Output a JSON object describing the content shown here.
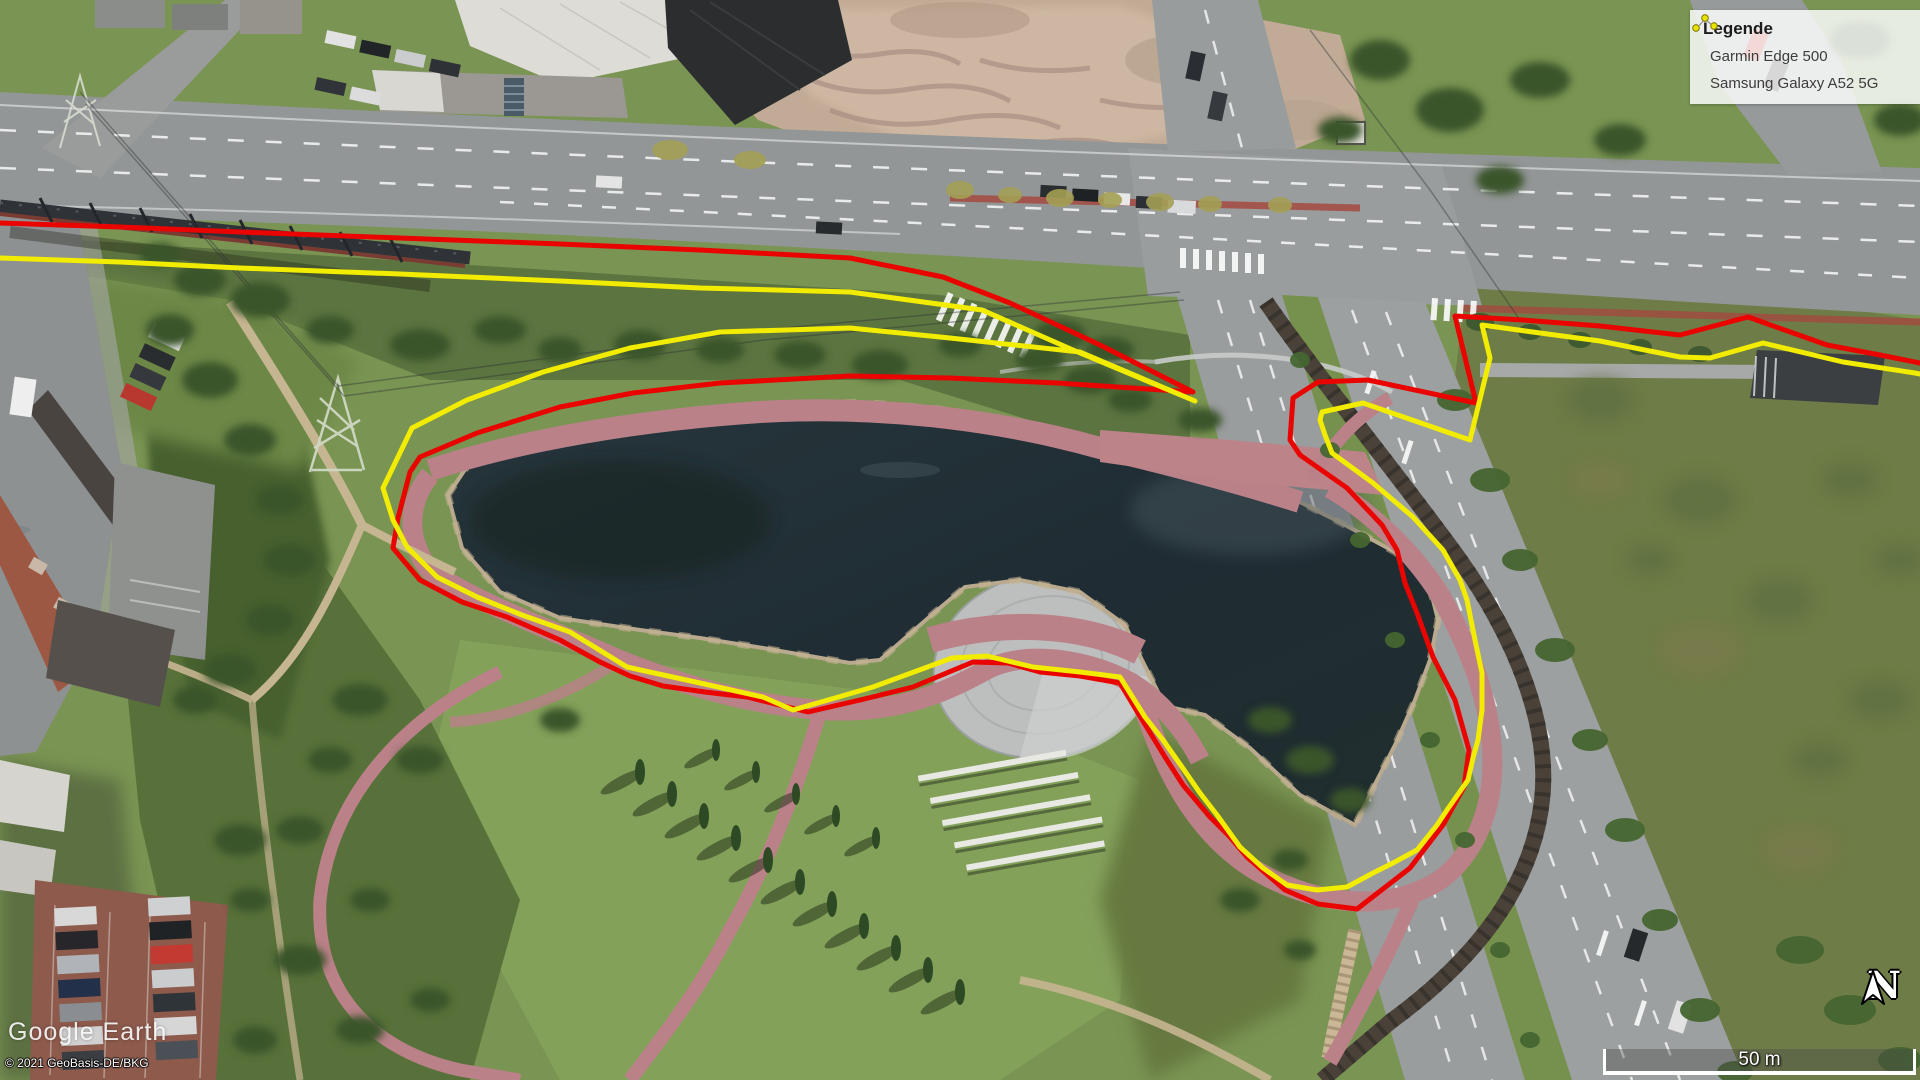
{
  "legend": {
    "title": "Legende",
    "items": [
      {
        "label": "Garmin Edge 500",
        "color": "#cc1f1f",
        "outline": "#7a0f0f"
      },
      {
        "label": "Samsung Galaxy A52 5G",
        "color": "#e8e400",
        "outline": "#8a8600"
      }
    ]
  },
  "watermark": {
    "brand": "Google Earth"
  },
  "attribution": {
    "copyright": "© 2021 GeoBasis-DE/BKG"
  },
  "scale_bar": {
    "label": "50 m"
  },
  "compass": {
    "label": "N"
  },
  "tracks": [
    {
      "name": "Garmin Edge 500",
      "color": "#ea0400",
      "width": 5,
      "points": [
        [
          0,
          223
        ],
        [
          120,
          227
        ],
        [
          240,
          232
        ],
        [
          400,
          238
        ],
        [
          560,
          244
        ],
        [
          700,
          250
        ],
        [
          850,
          258
        ],
        [
          943,
          277
        ],
        [
          1010,
          303
        ],
        [
          1100,
          345
        ],
        [
          1193,
          392
        ],
        [
          1057,
          383
        ],
        [
          950,
          378
        ],
        [
          850,
          376
        ],
        [
          720,
          383
        ],
        [
          633,
          393
        ],
        [
          560,
          407
        ],
        [
          477,
          433
        ],
        [
          420,
          457
        ],
        [
          410,
          472
        ],
        [
          398,
          518
        ],
        [
          393,
          548
        ],
        [
          420,
          580
        ],
        [
          462,
          602
        ],
        [
          507,
          617
        ],
        [
          560,
          640
        ],
        [
          600,
          662
        ],
        [
          630,
          676
        ],
        [
          663,
          686
        ],
        [
          705,
          692
        ],
        [
          747,
          697
        ],
        [
          808,
          712
        ],
        [
          860,
          700
        ],
        [
          913,
          687
        ],
        [
          973,
          662
        ],
        [
          1008,
          663
        ],
        [
          1040,
          672
        ],
        [
          1080,
          676
        ],
        [
          1120,
          683
        ],
        [
          1138,
          713
        ],
        [
          1165,
          757
        ],
        [
          1183,
          785
        ],
        [
          1210,
          817
        ],
        [
          1230,
          837
        ],
        [
          1247,
          857
        ],
        [
          1285,
          890
        ],
        [
          1318,
          904
        ],
        [
          1357,
          909
        ],
        [
          1410,
          868
        ],
        [
          1443,
          825
        ],
        [
          1464,
          787
        ],
        [
          1469,
          750
        ],
        [
          1455,
          700
        ],
        [
          1433,
          657
        ],
        [
          1417,
          613
        ],
        [
          1405,
          583
        ],
        [
          1397,
          550
        ],
        [
          1382,
          525
        ],
        [
          1347,
          488
        ],
        [
          1300,
          455
        ],
        [
          1290,
          440
        ],
        [
          1293,
          398
        ],
        [
          1318,
          382
        ],
        [
          1368,
          380
        ],
        [
          1476,
          403
        ],
        [
          1455,
          316
        ],
        [
          1523,
          320
        ],
        [
          1600,
          326
        ],
        [
          1680,
          335
        ],
        [
          1748,
          317
        ],
        [
          1827,
          345
        ],
        [
          1880,
          355
        ],
        [
          1920,
          363
        ]
      ]
    },
    {
      "name": "Samsung Galaxy A52 5G",
      "color": "#f2ec00",
      "width": 5,
      "points": [
        [
          0,
          258
        ],
        [
          120,
          262
        ],
        [
          240,
          268
        ],
        [
          400,
          274
        ],
        [
          560,
          281
        ],
        [
          700,
          288
        ],
        [
          850,
          292
        ],
        [
          982,
          310
        ],
        [
          1073,
          350
        ],
        [
          1195,
          401
        ],
        [
          1080,
          352
        ],
        [
          950,
          338
        ],
        [
          850,
          328
        ],
        [
          720,
          332
        ],
        [
          630,
          348
        ],
        [
          543,
          372
        ],
        [
          467,
          400
        ],
        [
          412,
          428
        ],
        [
          383,
          488
        ],
        [
          393,
          520
        ],
        [
          407,
          547
        ],
        [
          437,
          577
        ],
        [
          477,
          597
        ],
        [
          522,
          615
        ],
        [
          570,
          632
        ],
        [
          627,
          667
        ],
        [
          700,
          683
        ],
        [
          763,
          697
        ],
        [
          793,
          710
        ],
        [
          835,
          698
        ],
        [
          873,
          687
        ],
        [
          952,
          658
        ],
        [
          987,
          656
        ],
        [
          1033,
          667
        ],
        [
          1080,
          672
        ],
        [
          1120,
          677
        ],
        [
          1145,
          717
        ],
        [
          1163,
          740
        ],
        [
          1182,
          767
        ],
        [
          1200,
          793
        ],
        [
          1217,
          815
        ],
        [
          1240,
          847
        ],
        [
          1263,
          868
        ],
        [
          1287,
          885
        ],
        [
          1317,
          890
        ],
        [
          1347,
          887
        ],
        [
          1373,
          873
        ],
        [
          1393,
          863
        ],
        [
          1417,
          850
        ],
        [
          1437,
          825
        ],
        [
          1447,
          810
        ],
        [
          1468,
          780
        ],
        [
          1473,
          758
        ],
        [
          1478,
          740
        ],
        [
          1482,
          710
        ],
        [
          1482,
          673
        ],
        [
          1475,
          640
        ],
        [
          1467,
          600
        ],
        [
          1460,
          580
        ],
        [
          1443,
          550
        ],
        [
          1413,
          517
        ],
        [
          1373,
          483
        ],
        [
          1332,
          453
        ],
        [
          1325,
          435
        ],
        [
          1320,
          420
        ],
        [
          1322,
          412
        ],
        [
          1363,
          403
        ],
        [
          1470,
          440
        ],
        [
          1490,
          358
        ],
        [
          1482,
          325
        ],
        [
          1540,
          333
        ],
        [
          1600,
          341
        ],
        [
          1680,
          357
        ],
        [
          1710,
          358
        ],
        [
          1763,
          343
        ],
        [
          1843,
          362
        ],
        [
          1915,
          373
        ],
        [
          1920,
          374
        ]
      ]
    }
  ]
}
